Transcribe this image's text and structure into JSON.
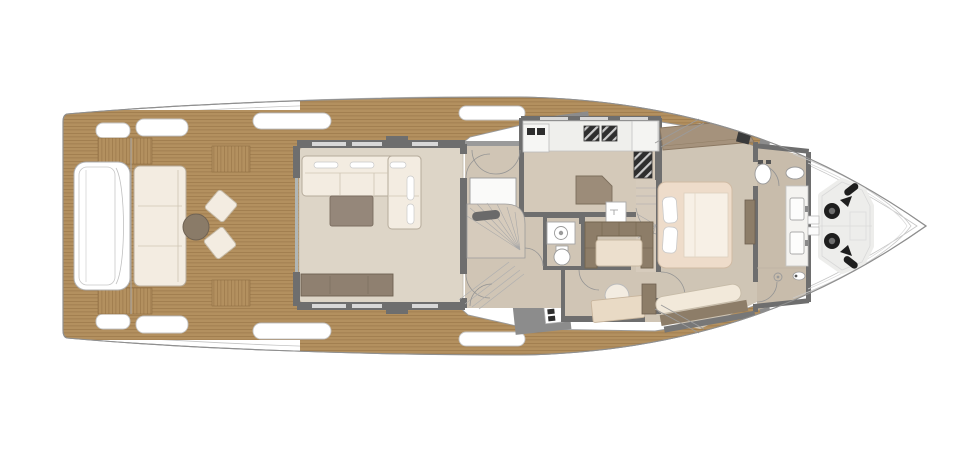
{
  "plan": {
    "kind": "yacht-main-deck-floor-plan",
    "orientation": "bow-right",
    "regions": [
      {
        "id": "swim-platform"
      },
      {
        "id": "transom-stairs"
      },
      {
        "id": "aft-cockpit"
      },
      {
        "id": "salon"
      },
      {
        "id": "galley"
      },
      {
        "id": "day-head"
      },
      {
        "id": "lower-deck-staircase"
      },
      {
        "id": "dinette"
      },
      {
        "id": "study"
      },
      {
        "id": "master-cabin"
      },
      {
        "id": "master-bathroom"
      },
      {
        "id": "foredeck"
      }
    ],
    "fixtures": [
      "cockpit-sofa",
      "round-table",
      "ottoman",
      "l-shaped-sofa",
      "coffee-table",
      "sideboard",
      "galley-counter",
      "cooktop",
      "oven",
      "sink",
      "toilet",
      "bidet",
      "dinette-settee",
      "dinette-table",
      "desk",
      "desk-chair",
      "double-bed",
      "pillows",
      "vanity-twin-sinks",
      "shower-drain",
      "wardrobe",
      "anchor-windlass",
      "mooring-cleat"
    ]
  },
  "colors": {
    "paper": "#ffffff",
    "hull_line": "#8f8f8f",
    "hull_inner_line": "#c4c4c4",
    "teak": "#b3905f",
    "teak_plank": "#9c784a",
    "wall": "#6e6e6e",
    "gate_gray": "#8c8c8c",
    "sill_gray": "#9a9a9a",
    "salon_floor": "#ddd5c7",
    "mid_floor": "#d0c5b5",
    "galley_floor": "#d4c9b9",
    "master_floor": "#cfc5b5",
    "bath_floor": "#c8bcab",
    "stairs_floor": "#d6cbbc",
    "cream": "#f3ece1",
    "cream_line": "#b8ad9c",
    "taupe": "#95877a",
    "brown": "#8d7d68",
    "wardrobe": "#a5927c",
    "counter": "#efefec",
    "island": "#9c8c79",
    "bed_frame": "#eedcca",
    "mattress": "#f7f0e6",
    "table_cream": "#ecdfcd",
    "fixture_white": "#ffffff",
    "appliance": "#2e2e2e",
    "gear_black": "#1e1e1e",
    "pad": "#ededeb"
  }
}
